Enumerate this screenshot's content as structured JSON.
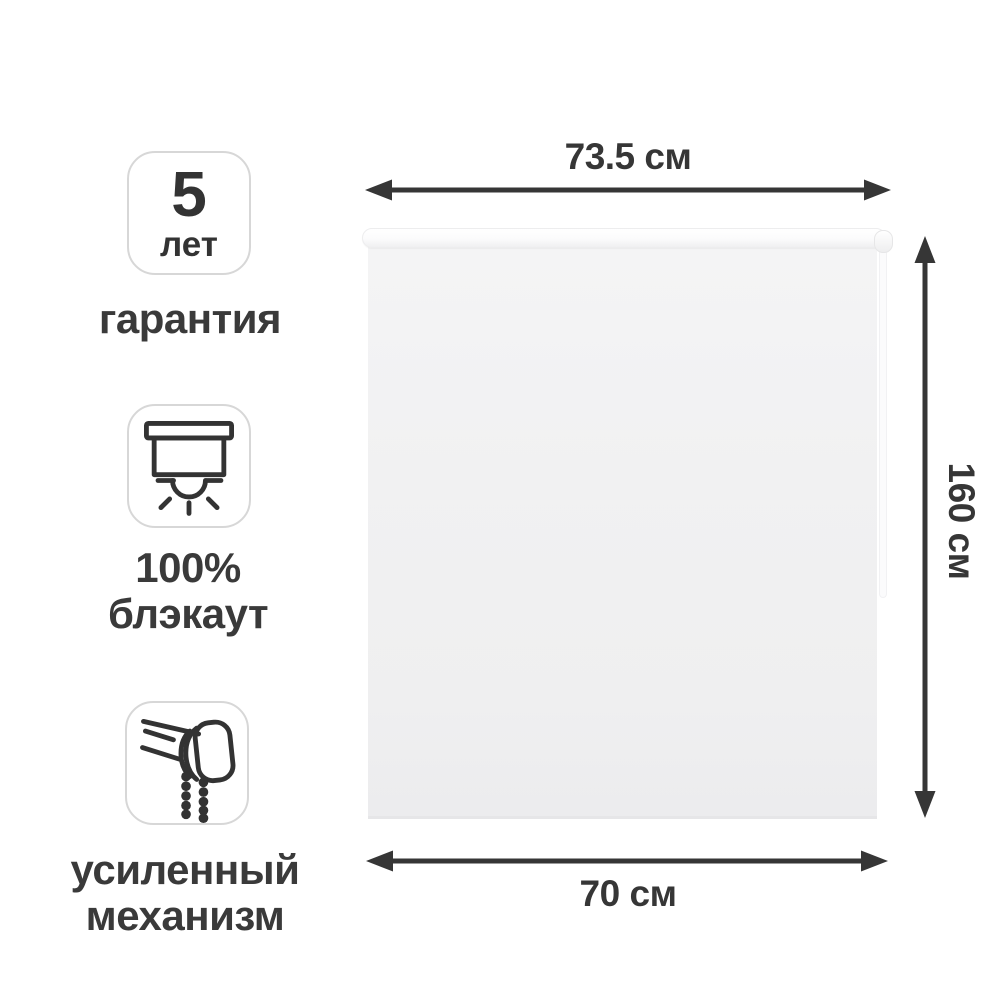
{
  "features": [
    {
      "badge_value": "5",
      "badge_unit": "лет",
      "caption": "гарантия"
    },
    {
      "icon": "blackout-icon",
      "caption_line1": "100%",
      "caption_line2": "блэкаут"
    },
    {
      "icon": "reinforced-mechanism-icon",
      "caption_line1": "усиленный",
      "caption_line2": "механизм"
    }
  ],
  "dimensions": {
    "top_width": "73.5 см",
    "height": "160 см",
    "bottom_width": "70 см"
  },
  "colors": {
    "text": "#363636",
    "arrow": "#363636",
    "badge_border": "#d7d7d7",
    "icon_stroke": "#333333",
    "fabric": "#f0f0f1",
    "background": "#ffffff"
  }
}
